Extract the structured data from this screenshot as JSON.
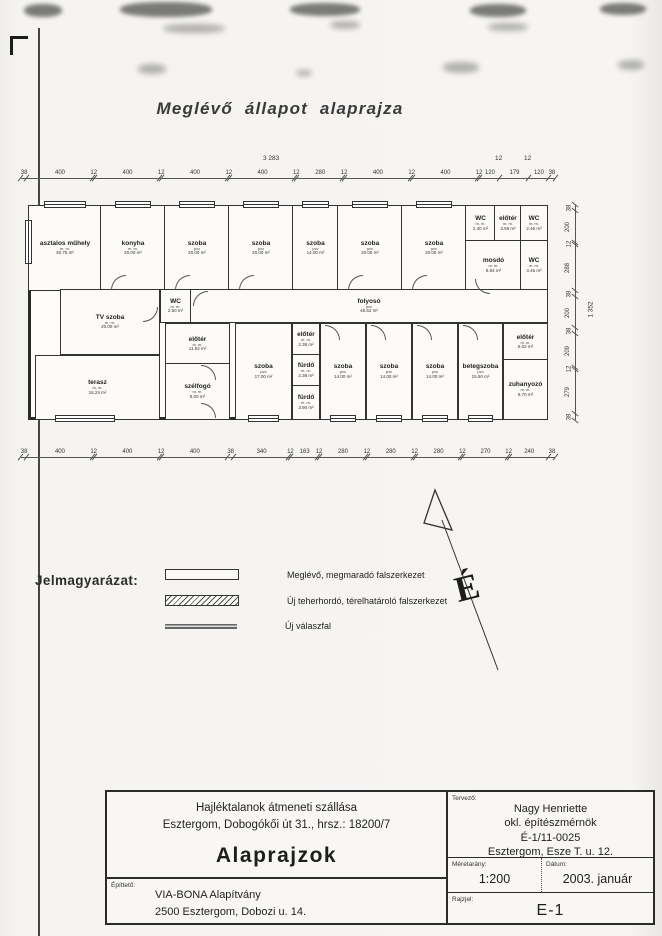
{
  "title": "Meglévő állapot alaprajza",
  "plan": {
    "overall_width": "3 283",
    "overall_height": "1 352",
    "top_extra_dims": [
      "12",
      "12"
    ],
    "top_dims": [
      "38",
      "400",
      "12",
      "400",
      "12",
      "400",
      "12",
      "400",
      "12",
      "280",
      "12",
      "400",
      "12",
      "400",
      "12",
      "120",
      "179",
      "120",
      "38"
    ],
    "bottom_dims": [
      "38",
      "400",
      "12",
      "400",
      "12",
      "400",
      "38",
      "340",
      "12",
      "163",
      "12",
      "280",
      "12",
      "280",
      "12",
      "280",
      "12",
      "270",
      "12",
      "240",
      "38"
    ],
    "right_dims": [
      "38",
      "200",
      "12",
      "288",
      "38",
      "200",
      "38",
      "209",
      "12",
      "279",
      "38"
    ],
    "rooms": [
      {
        "name": "asztalos műhely",
        "sub": "m. m.",
        "area": "40.75 m²"
      },
      {
        "name": "konyha",
        "sub": "m. m.",
        "area": "20.00 m²"
      },
      {
        "name": "szoba",
        "sub": "pvc",
        "area": "20.00 m²"
      },
      {
        "name": "szoba",
        "sub": "pvc",
        "area": "20.00 m²"
      },
      {
        "name": "szoba",
        "sub": "pvc",
        "area": "14.00 m²"
      },
      {
        "name": "szoba",
        "sub": "pvc",
        "area": "20.00 m²"
      },
      {
        "name": "szoba",
        "sub": "pvc",
        "area": "20.00 m²"
      },
      {
        "name": "WC",
        "sub": "m. m.",
        "area": "2.40 m²"
      },
      {
        "name": "előtér",
        "sub": "m. m.",
        "area": "3.58 m²"
      },
      {
        "name": "WC",
        "sub": "m. m.",
        "area": "2.46 m²"
      },
      {
        "name": "mosdó",
        "sub": "m. m.",
        "area": "8.94 m²"
      },
      {
        "name": "WC",
        "sub": "m. m.",
        "area": "3.46 m²"
      },
      {
        "name": "folyosó",
        "sub": "pvc",
        "area": "45.62 m²"
      },
      {
        "name": "TV szoba",
        "sub": "m. m.",
        "area": "20.00 m²"
      },
      {
        "name": "WC",
        "sub": "m. m.",
        "area": "2.50 m²"
      },
      {
        "name": "előtér",
        "sub": "m. m.",
        "area": "11.52 m²"
      },
      {
        "name": "szélfogó",
        "sub": "m. m.",
        "area": "8.00 m²"
      },
      {
        "name": "terasz",
        "sub": "m. m.",
        "area": "16.24 m²"
      },
      {
        "name": "szoba",
        "sub": "pvc",
        "area": "17.00 m²"
      },
      {
        "name": "előtér",
        "sub": "m. m.",
        "area": "2.38 m²"
      },
      {
        "name": "fürdő",
        "sub": "m. m.",
        "area": "2.38 m²"
      },
      {
        "name": "fürdő",
        "sub": "m. m.",
        "area": "3.90 m²"
      },
      {
        "name": "szoba",
        "sub": "pvc",
        "area": "14.00 m²"
      },
      {
        "name": "szoba",
        "sub": "pvc",
        "area": "14.00 m²"
      },
      {
        "name": "szoba",
        "sub": "pvc",
        "area": "14.00 m²"
      },
      {
        "name": "betegszoba",
        "sub": "pvc",
        "area": "15.50 m²"
      },
      {
        "name": "előtér",
        "sub": "m. m.",
        "area": "5.02 m²"
      },
      {
        "name": "zuhanyozó",
        "sub": "m. m.",
        "area": "6.70 m²"
      }
    ]
  },
  "north": {
    "label": "É"
  },
  "legend": {
    "heading": "Jelmagyarázat:",
    "items": [
      {
        "label": "Meglévő, megmaradó falszerkezet",
        "swatch": "existing"
      },
      {
        "label": "Új teherhordó, térelhatároló falszerkezet",
        "swatch": "load"
      },
      {
        "label": "Új válaszfal",
        "swatch": "partition"
      }
    ]
  },
  "title_block": {
    "project_line1": "Hajléktalanok átmeneti szállása",
    "project_line2": "Esztergom, Dobogókői út 31., hrsz.: 18200/7",
    "drawing_title": "Alaprajzok",
    "client_label": "Építtető:",
    "client_line1": "VIA-BONA Alapítvány",
    "client_line2": "2500 Esztergom, Dobozi u. 14.",
    "designer_label": "Tervező:",
    "designer_line1": "Nagy Henriette",
    "designer_line2": "okl. építészmérnök",
    "designer_line3": "É-1/11-0025",
    "designer_line4": "Esztergom, Esze T. u. 12.",
    "scale_label": "Méretarány:",
    "scale_value": "1:200",
    "date_label": "Dátum:",
    "date_value": "2003. január",
    "sheet_label": "Rajzjel:",
    "sheet_value": "E-1"
  },
  "colors": {
    "ink": "#2a2a2a",
    "paper": "#f5f4f1"
  }
}
